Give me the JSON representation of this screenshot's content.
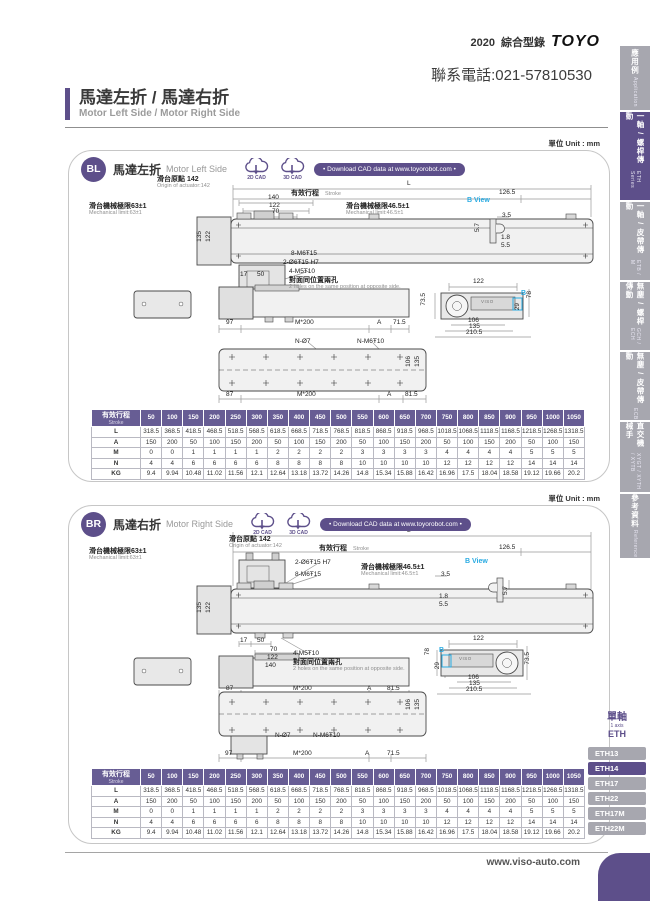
{
  "header": {
    "edition": "2020",
    "catalog_title": "綜合型錄",
    "brand": "TOYO",
    "phone": "聯系電話:021-57810530"
  },
  "page_title": {
    "zh": "馬達左折 / 馬達右折",
    "en": "Motor Left Side / Motor Right Side"
  },
  "colors": {
    "accent": "#5d4f8a",
    "table_header": "#675d94",
    "tab_gray": "#a7a7af",
    "b_view_cyan": "#29abe2"
  },
  "sidebar": {
    "tabs": [
      {
        "zh": "應用例",
        "en": "Application",
        "active": false
      },
      {
        "zh": "一軸 / 螺桿傳動",
        "en": "ETH Series",
        "active": true
      },
      {
        "zh": "一軸 / 皮帶傳動",
        "en": "ETB / M",
        "active": false
      },
      {
        "zh": "無塵 / 螺桿傳動",
        "en": "GCH / ECH",
        "active": false
      },
      {
        "zh": "無塵 / 皮帶傳動",
        "en": "ECB",
        "active": false
      },
      {
        "zh": "直交機械手",
        "en": "XYGT / XYTH / XYTB",
        "active": false
      },
      {
        "zh": "參考資料",
        "en": "Reference",
        "active": false
      }
    ]
  },
  "series_nav": {
    "axis_zh": "單軸",
    "axis_en": "1 axis",
    "series": "ETH",
    "items": [
      {
        "label": "ETH13",
        "active": false
      },
      {
        "label": "ETH14",
        "active": true
      },
      {
        "label": "ETH17",
        "active": false
      },
      {
        "label": "ETH22",
        "active": false
      },
      {
        "label": "ETH17M",
        "active": false
      },
      {
        "label": "ETH22M",
        "active": false
      }
    ]
  },
  "footer": {
    "website": "www.viso-auto.com"
  },
  "panels": [
    {
      "badge": "BL",
      "title_zh": "馬達左折",
      "title_en": "Motor Left Side",
      "unit_label": "單位 Unit : mm",
      "cad": {
        "two_d": "2D CAD",
        "three_d": "3D CAD",
        "download": "• Download CAD data at www.toyorobot.com •"
      },
      "annotations": [
        {
          "t": "L",
          "x": 338,
          "y": 30
        },
        {
          "t": "滑台原點 142",
          "x": 88,
          "y": 25,
          "c": "zh"
        },
        {
          "t": "Origin of actuator:142",
          "x": 88,
          "y": 33,
          "c": "en"
        },
        {
          "t": "有效行程",
          "x": 222,
          "y": 39,
          "c": "zh"
        },
        {
          "t": "Stroke",
          "x": 256,
          "y": 41,
          "c": "en"
        },
        {
          "t": "126.5",
          "x": 430,
          "y": 39
        },
        {
          "t": "140",
          "x": 199,
          "y": 44
        },
        {
          "t": "122",
          "x": 200,
          "y": 52
        },
        {
          "t": "70",
          "x": 203,
          "y": 58
        },
        {
          "t": "滑台機械極限63±1",
          "x": 20,
          "y": 52,
          "c": "zh"
        },
        {
          "t": "Mechanical limit:63±1",
          "x": 20,
          "y": 60,
          "c": "en"
        },
        {
          "t": "滑台機械極限46.5±1",
          "x": 277,
          "y": 52,
          "c": "zh"
        },
        {
          "t": "Mechanical limit:46.5±1",
          "x": 277,
          "y": 60,
          "c": "en"
        },
        {
          "t": "135",
          "x": 128,
          "y": 80,
          "r": 1
        },
        {
          "t": "122",
          "x": 137,
          "y": 80,
          "r": 1
        },
        {
          "t": "8-M6Ŧ15",
          "x": 222,
          "y": 100
        },
        {
          "t": "2-Ø6Ŧ15 H7",
          "x": 214,
          "y": 109
        },
        {
          "t": "4-M5Ŧ10",
          "x": 220,
          "y": 118
        },
        {
          "t": "對面同位置兩孔",
          "x": 220,
          "y": 126,
          "c": "zh"
        },
        {
          "t": "2 holes on the same position at opposite side.",
          "x": 220,
          "y": 134,
          "c": "en"
        },
        {
          "t": "17",
          "x": 171,
          "y": 121
        },
        {
          "t": "50",
          "x": 188,
          "y": 121
        },
        {
          "t": "97",
          "x": 157,
          "y": 169
        },
        {
          "t": "M*200",
          "x": 226,
          "y": 169
        },
        {
          "t": "A",
          "x": 308,
          "y": 169
        },
        {
          "t": "71.5",
          "x": 324,
          "y": 169
        },
        {
          "t": "N-Ø7",
          "x": 226,
          "y": 188
        },
        {
          "t": "N-M6Ŧ10",
          "x": 288,
          "y": 188
        },
        {
          "t": "106",
          "x": 337,
          "y": 205,
          "r": 1
        },
        {
          "t": "135",
          "x": 346,
          "y": 205,
          "r": 1
        },
        {
          "t": "87",
          "x": 157,
          "y": 241
        },
        {
          "t": "M*200",
          "x": 228,
          "y": 241
        },
        {
          "t": "A",
          "x": 318,
          "y": 241
        },
        {
          "t": "81.5",
          "x": 336,
          "y": 241
        },
        {
          "t": "122",
          "x": 404,
          "y": 128
        },
        {
          "t": "73.5",
          "x": 352,
          "y": 142,
          "r": 1
        },
        {
          "t": "78",
          "x": 458,
          "y": 140,
          "r": 1
        },
        {
          "t": "29",
          "x": 446,
          "y": 152,
          "r": 1
        },
        {
          "t": "B",
          "x": 452,
          "y": 139,
          "c": "bv"
        },
        {
          "t": "VISO",
          "x": 412,
          "y": 149,
          "c": "tiny"
        },
        {
          "t": "106",
          "x": 399,
          "y": 167
        },
        {
          "t": "135",
          "x": 400,
          "y": 173
        },
        {
          "t": "210.5",
          "x": 397,
          "y": 179
        },
        {
          "t": "B View",
          "x": 398,
          "y": 46,
          "c": "bv"
        },
        {
          "t": "3.5",
          "x": 433,
          "y": 62
        },
        {
          "t": "5.7",
          "x": 406,
          "y": 72,
          "r": 1
        },
        {
          "t": "1.8",
          "x": 432,
          "y": 84
        },
        {
          "t": "5.5",
          "x": 432,
          "y": 92
        }
      ],
      "table": {
        "header_zh": "有效行程",
        "header_en": "Stroke",
        "strokes": [
          "50",
          "100",
          "150",
          "200",
          "250",
          "300",
          "350",
          "400",
          "450",
          "500",
          "550",
          "600",
          "650",
          "700",
          "750",
          "800",
          "850",
          "900",
          "950",
          "1000",
          "1050"
        ],
        "rows": [
          {
            "label": "L",
            "values": [
              "318.5",
              "368.5",
              "418.5",
              "468.5",
              "518.5",
              "568.5",
              "618.5",
              "668.5",
              "718.5",
              "768.5",
              "818.5",
              "868.5",
              "918.5",
              "968.5",
              "1018.5",
              "1068.5",
              "1118.5",
              "1168.5",
              "1218.5",
              "1268.5",
              "1318.5"
            ]
          },
          {
            "label": "A",
            "values": [
              "150",
              "200",
              "50",
              "100",
              "150",
              "200",
              "50",
              "100",
              "150",
              "200",
              "50",
              "100",
              "150",
              "200",
              "50",
              "100",
              "150",
              "200",
              "50",
              "100",
              "150"
            ]
          },
          {
            "label": "M",
            "values": [
              "0",
              "0",
              "1",
              "1",
              "1",
              "1",
              "2",
              "2",
              "2",
              "2",
              "3",
              "3",
              "3",
              "3",
              "4",
              "4",
              "4",
              "4",
              "5",
              "5",
              "5"
            ]
          },
          {
            "label": "N",
            "values": [
              "4",
              "4",
              "6",
              "6",
              "6",
              "6",
              "8",
              "8",
              "8",
              "8",
              "10",
              "10",
              "10",
              "10",
              "12",
              "12",
              "12",
              "12",
              "14",
              "14",
              "14"
            ]
          },
          {
            "label": "KG",
            "values": [
              "9.4",
              "9.94",
              "10.48",
              "11.02",
              "11.56",
              "12.1",
              "12.64",
              "13.18",
              "13.72",
              "14.26",
              "14.8",
              "15.34",
              "15.88",
              "16.42",
              "16.96",
              "17.5",
              "18.04",
              "18.58",
              "19.12",
              "19.66",
              "20.2"
            ]
          }
        ]
      }
    },
    {
      "badge": "BR",
      "title_zh": "馬達右折",
      "title_en": "Motor Right Side",
      "unit_label": "單位 Unit : mm",
      "cad": {
        "two_d": "2D CAD",
        "three_d": "3D CAD",
        "download": "• Download CAD data at www.toyorobot.com •"
      },
      "annotations": [
        {
          "t": "L",
          "x": 338,
          "y": 22
        },
        {
          "t": "滑台機械極限63±1",
          "x": 20,
          "y": 42,
          "c": "zh"
        },
        {
          "t": "Mechanical limit:63±1",
          "x": 20,
          "y": 50,
          "c": "en"
        },
        {
          "t": "滑台原點 142",
          "x": 160,
          "y": 30,
          "c": "zh"
        },
        {
          "t": "Origin of actuator:142",
          "x": 160,
          "y": 38,
          "c": "en"
        },
        {
          "t": "有效行程",
          "x": 250,
          "y": 39,
          "c": "zh"
        },
        {
          "t": "Stroke",
          "x": 284,
          "y": 41,
          "c": "en"
        },
        {
          "t": "126.5",
          "x": 430,
          "y": 39
        },
        {
          "t": "2-Ø6Ŧ15 H7",
          "x": 226,
          "y": 54
        },
        {
          "t": "8-M6Ŧ15",
          "x": 226,
          "y": 66
        },
        {
          "t": "滑台機械極限46.5±1",
          "x": 292,
          "y": 58,
          "c": "zh"
        },
        {
          "t": "Mechanical limit:46.5±1",
          "x": 292,
          "y": 66,
          "c": "en"
        },
        {
          "t": "135",
          "x": 128,
          "y": 96,
          "r": 1
        },
        {
          "t": "122",
          "x": 137,
          "y": 96,
          "r": 1
        },
        {
          "t": "17",
          "x": 171,
          "y": 132
        },
        {
          "t": "50",
          "x": 188,
          "y": 132
        },
        {
          "t": "70",
          "x": 201,
          "y": 141
        },
        {
          "t": "122",
          "x": 198,
          "y": 149
        },
        {
          "t": "140",
          "x": 196,
          "y": 157
        },
        {
          "t": "4-M5Ŧ10",
          "x": 224,
          "y": 145
        },
        {
          "t": "對面同位置兩孔",
          "x": 224,
          "y": 153,
          "c": "zh"
        },
        {
          "t": "2 holes on the same position at opposite side.",
          "x": 224,
          "y": 161,
          "c": "en"
        },
        {
          "t": "87",
          "x": 157,
          "y": 180
        },
        {
          "t": "M*200",
          "x": 224,
          "y": 180
        },
        {
          "t": "A",
          "x": 298,
          "y": 180
        },
        {
          "t": "81.5",
          "x": 318,
          "y": 180
        },
        {
          "t": "122",
          "x": 404,
          "y": 130
        },
        {
          "t": "78",
          "x": 356,
          "y": 142,
          "r": 1
        },
        {
          "t": "29",
          "x": 366,
          "y": 156,
          "r": 1
        },
        {
          "t": "B",
          "x": 370,
          "y": 141,
          "c": "bv"
        },
        {
          "t": "VISO",
          "x": 390,
          "y": 151,
          "c": "tiny"
        },
        {
          "t": "73.5",
          "x": 456,
          "y": 146,
          "r": 1
        },
        {
          "t": "106",
          "x": 399,
          "y": 169
        },
        {
          "t": "135",
          "x": 400,
          "y": 175
        },
        {
          "t": "210.5",
          "x": 397,
          "y": 181
        },
        {
          "t": "B View",
          "x": 396,
          "y": 52,
          "c": "bv"
        },
        {
          "t": "3.5",
          "x": 372,
          "y": 66
        },
        {
          "t": "5.7",
          "x": 434,
          "y": 80,
          "r": 1
        },
        {
          "t": "1.8",
          "x": 370,
          "y": 88
        },
        {
          "t": "5.5",
          "x": 370,
          "y": 96
        },
        {
          "t": "N-Ø7",
          "x": 206,
          "y": 227
        },
        {
          "t": "N-M6Ŧ10",
          "x": 244,
          "y": 227
        },
        {
          "t": "106",
          "x": 337,
          "y": 193,
          "r": 1
        },
        {
          "t": "135",
          "x": 346,
          "y": 193,
          "r": 1
        },
        {
          "t": "97",
          "x": 156,
          "y": 245
        },
        {
          "t": "M*200",
          "x": 224,
          "y": 245
        },
        {
          "t": "A",
          "x": 296,
          "y": 245
        },
        {
          "t": "71.5",
          "x": 318,
          "y": 245
        }
      ],
      "table": {
        "header_zh": "有效行程",
        "header_en": "Stroke",
        "strokes": [
          "50",
          "100",
          "150",
          "200",
          "250",
          "300",
          "350",
          "400",
          "450",
          "500",
          "550",
          "600",
          "650",
          "700",
          "750",
          "800",
          "850",
          "900",
          "950",
          "1000",
          "1050"
        ],
        "rows": [
          {
            "label": "L",
            "values": [
              "318.5",
              "368.5",
              "418.5",
              "468.5",
              "518.5",
              "568.5",
              "618.5",
              "668.5",
              "718.5",
              "768.5",
              "818.5",
              "868.5",
              "918.5",
              "968.5",
              "1018.5",
              "1068.5",
              "1118.5",
              "1168.5",
              "1218.5",
              "1268.5",
              "1318.5"
            ]
          },
          {
            "label": "A",
            "values": [
              "150",
              "200",
              "50",
              "100",
              "150",
              "200",
              "50",
              "100",
              "150",
              "200",
              "50",
              "100",
              "150",
              "200",
              "50",
              "100",
              "150",
              "200",
              "50",
              "100",
              "150"
            ]
          },
          {
            "label": "M",
            "values": [
              "0",
              "0",
              "1",
              "1",
              "1",
              "1",
              "2",
              "2",
              "2",
              "2",
              "3",
              "3",
              "3",
              "3",
              "4",
              "4",
              "4",
              "4",
              "5",
              "5",
              "5"
            ]
          },
          {
            "label": "N",
            "values": [
              "4",
              "4",
              "6",
              "6",
              "6",
              "6",
              "8",
              "8",
              "8",
              "8",
              "10",
              "10",
              "10",
              "10",
              "12",
              "12",
              "12",
              "12",
              "14",
              "14",
              "14"
            ]
          },
          {
            "label": "KG",
            "values": [
              "9.4",
              "9.94",
              "10.48",
              "11.02",
              "11.56",
              "12.1",
              "12.64",
              "13.18",
              "13.72",
              "14.26",
              "14.8",
              "15.34",
              "15.88",
              "16.42",
              "16.96",
              "17.5",
              "18.04",
              "18.58",
              "19.12",
              "19.66",
              "20.2"
            ]
          }
        ]
      }
    }
  ]
}
